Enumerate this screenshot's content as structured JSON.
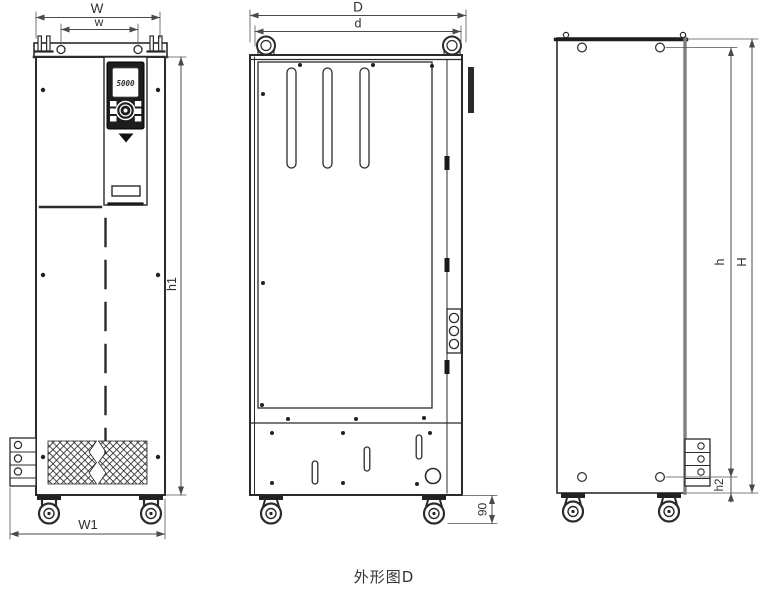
{
  "caption": "外形图D",
  "keypad": {
    "display_value": "5000"
  },
  "dimensions": {
    "W": "W",
    "w": "w",
    "h1": "h1",
    "W1": "W1",
    "D": "D",
    "d": "d",
    "caster_height": "90",
    "h": "h",
    "H": "H",
    "h2": "h2"
  },
  "colors": {
    "line": "#2b2b2b",
    "dimension_line": "#4a4a4a",
    "secondary_edge": "#808080",
    "keypad_body": "#1d1d1d",
    "background": "#ffffff"
  }
}
